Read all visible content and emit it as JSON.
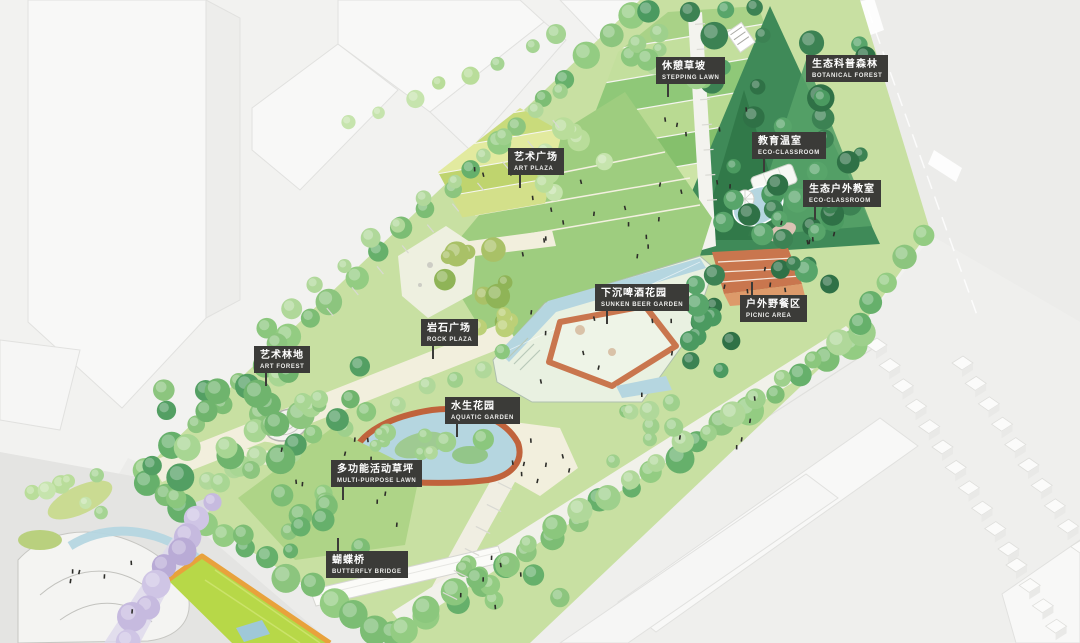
{
  "plan": {
    "areas": [
      {
        "id": "stepping-lawn",
        "zh": "休憩草坡",
        "en": "STEPPING LAWN"
      },
      {
        "id": "botanical-forest",
        "zh": "生态科普森林",
        "en": "BOTANICAL FOREST"
      },
      {
        "id": "art-plaza",
        "zh": "艺术广场",
        "en": "ART PLAZA"
      },
      {
        "id": "edu-greenhouse",
        "zh": "教育温室",
        "en": "ECO-CLASSROOM"
      },
      {
        "id": "outdoor-eco-classroom",
        "zh": "生态户外教室",
        "en": "ECO-CLASSROOM"
      },
      {
        "id": "sunken-beer-garden",
        "zh": "下沉啤酒花园",
        "en": "SUNKEN BEER GARDEN"
      },
      {
        "id": "picnic-area",
        "zh": "户外野餐区",
        "en": "PICNIC AREA"
      },
      {
        "id": "rock-plaza",
        "zh": "岩石广场",
        "en": "ROCK PLAZA"
      },
      {
        "id": "art-forest",
        "zh": "艺术林地",
        "en": "ART FOREST"
      },
      {
        "id": "aquatic-garden",
        "zh": "水生花园",
        "en": "AQUATIC GARDEN"
      },
      {
        "id": "multi-purpose-lawn",
        "zh": "多功能活动草坪",
        "en": "MULTI-PURPOSE LAWN"
      },
      {
        "id": "butterfly-bridge",
        "zh": "蝴蝶桥",
        "en": "BUTTERFLY BRIDGE"
      }
    ],
    "colors": {
      "label_bg": "#3b3b38",
      "label_text": "#ffffff",
      "lawn": "#c8e0a2",
      "forest_dark": "#3f8a58",
      "water": "#b5d6e0",
      "terracotta": "#c9764e",
      "path_cream": "#f2efdd",
      "road": "#ececea",
      "building": "#f8f8f7",
      "lavender": "#ded9ec",
      "field_green": "#b7d848",
      "field_edge_orange": "#e8a23c"
    }
  }
}
